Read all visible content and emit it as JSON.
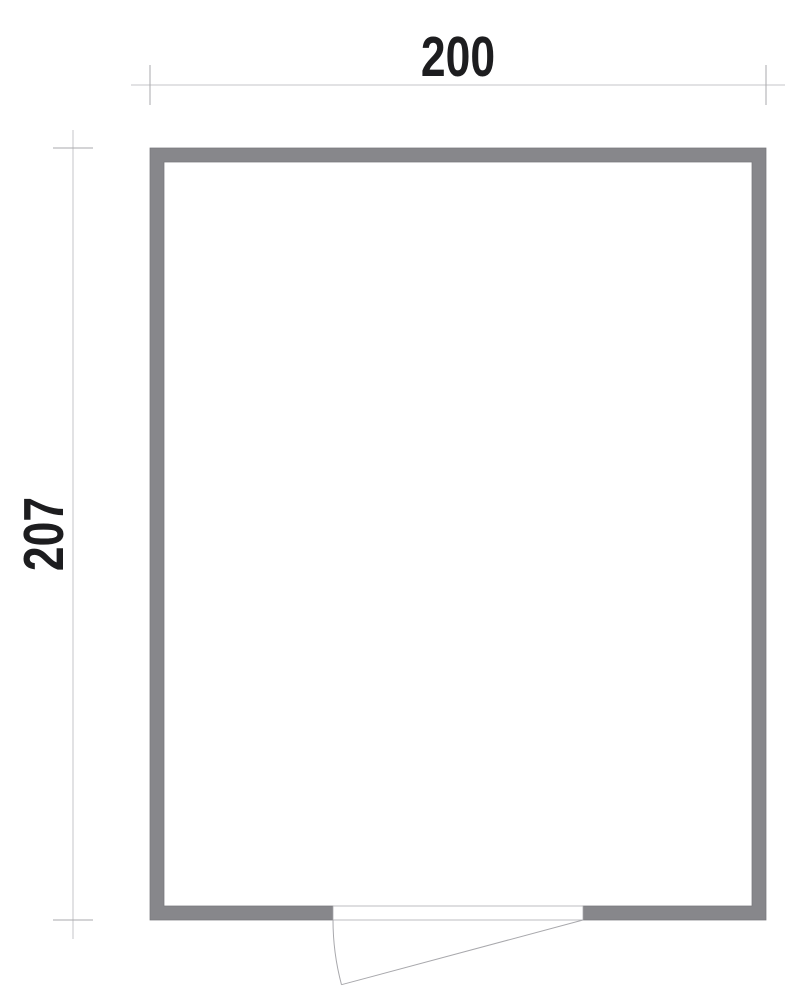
{
  "plan": {
    "width_label": "200",
    "height_label": "207"
  },
  "colors": {
    "background": "#ffffff",
    "wall_fill": "#87878b",
    "wall_outline": "#78787c",
    "dim_line": "#c6c6c8",
    "dim_tick": "#aaaaac",
    "door_line": "#a8a8ac",
    "text_color": "#1d1d1f"
  }
}
